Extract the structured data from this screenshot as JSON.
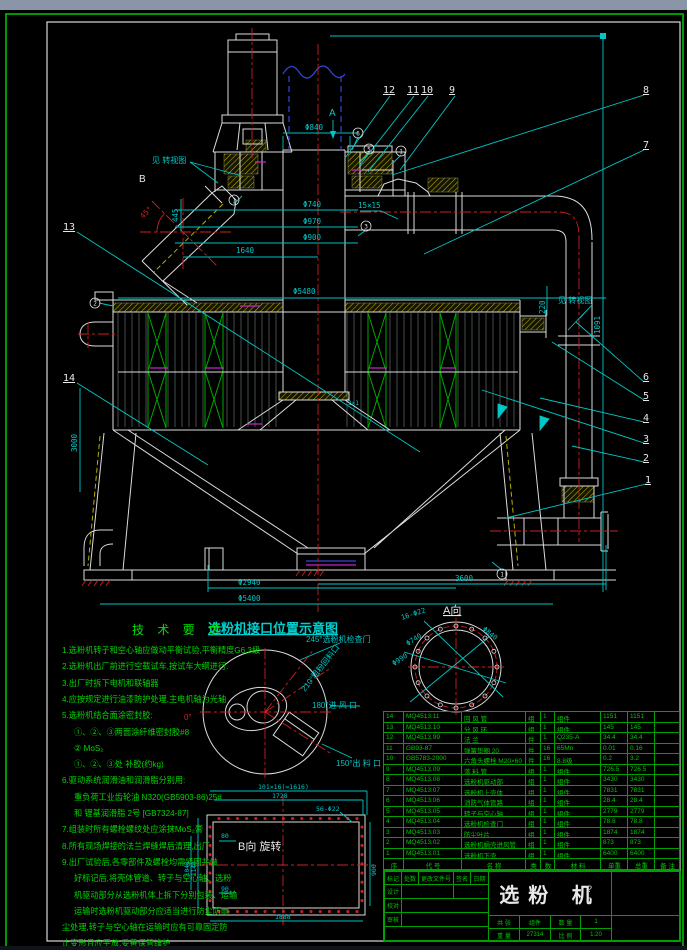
{
  "window": {
    "topbar_color": "#8b95a8",
    "paper_border_color": "#00c000"
  },
  "callouts": {
    "n1": "1",
    "n2": "2",
    "n3": "3",
    "n4": "4",
    "n5": "5",
    "n6": "6",
    "n7": "7",
    "n8": "8",
    "n9": "9",
    "n10": "10",
    "n11": "11",
    "n12": "12",
    "n13": "13",
    "n14": "14"
  },
  "circled": {
    "p6": "6",
    "p5": "5",
    "p1a": "1",
    "p1b": "1",
    "p3": "3",
    "p2": "2",
    "p1c": "1"
  },
  "views": {
    "arrow_a": "A",
    "arrow_b": "B",
    "rot_view_left": "见 转视图",
    "rot_view_right": "见 转视图",
    "a_view": "A向",
    "b_view": "B向 旋转",
    "schematic_title": "选粉机接口位置示意图"
  },
  "dims": {
    "phi840": "Φ840",
    "phi740": "Φ740",
    "phi970": "Φ970",
    "phi900": "Φ900",
    "d15": "15×15",
    "d1640": "1640",
    "phi5480": "Φ5480",
    "d445": "445",
    "d45": "45°",
    "d3000": "3000",
    "d220": "220",
    "d1091": "1091",
    "d3600": "3600",
    "phi2940": "Φ2940",
    "phi5400": "Φ5400",
    "d2x1": "2×1"
  },
  "schematic": {
    "deg0": "0°",
    "deg245": "245°选粉机检查门",
    "deg210": "210°粗粉回料口",
    "deg180": "180°进 风 口",
    "deg150": "150°出 料 口"
  },
  "a_view_dims": {
    "bolts": "16-Φ22",
    "phi740": "Φ740",
    "phi990": "Φ990",
    "phi840": "Φ840"
  },
  "b_view_dims": {
    "pitch": "101×16(=1616)",
    "w1728": "1728",
    "bolts": "56-Φ22",
    "d80": "80",
    "d90": "90",
    "h900": "900",
    "w1888": "1888",
    "h1140": "1140",
    "h1040": "1040"
  },
  "tech": {
    "title": "技 术 要 求",
    "lines": [
      {
        "t": "1.选粉机转子和空心轴应做动平衡试验,平衡精度G6.3级",
        "i": 0
      },
      {
        "t": "2.选粉机出厂前进行空载试车,按试车大纲进行.",
        "i": 0
      },
      {
        "t": "3.出厂时拆下电机和联轴器",
        "i": 0
      },
      {
        "t": "4.应按规定进行油漆防护处理,主电机轴为光轴",
        "i": 0
      },
      {
        "t": "5.选粉机结合面涂密封胶:",
        "i": 0
      },
      {
        "t": "①、②、③两面涂纤维密封胶#8",
        "i": 1
      },
      {
        "t": "② MoS₂",
        "i": 1
      },
      {
        "t": "①、②、③处 补胶(约kg)",
        "i": 1
      },
      {
        "t": "6.驱动系统润滑油和润滑脂分别用:",
        "i": 0
      },
      {
        "t": "重负荷工业齿轮油 N320(GB5903-86)25#",
        "i": 1
      },
      {
        "t": "和 锂基润滑脂 2号 [GB7324-87]",
        "i": 1
      },
      {
        "t": "7.组装时所有螺栓螺纹处应涂抹MoS₂膏",
        "i": 0
      },
      {
        "t": "8.所有现场焊接的法兰焊缝焊后清理,出厂",
        "i": 0
      },
      {
        "t": "9.出厂试验后,各零部件及螺栓均需紧固并做",
        "i": 0
      },
      {
        "t": "好标记后,将壳体管道、转子与空心轴、选粉",
        "i": 1
      },
      {
        "t": "机驱动部分从选粉机体上拆下分别包装、运输",
        "i": 1
      },
      {
        "t": "运输时选粉机驱动部分应适当进行防尘防雨",
        "i": 1
      },
      {
        "t": "尘处理,转子与空心轴在运输时应有可靠固定防",
        "i": 0
      },
      {
        "t": "止变形且应平放,妥善保管维护",
        "i": 0
      }
    ]
  },
  "parts_table": {
    "headers": [
      "序",
      "代 号",
      "名 称",
      "类",
      "数",
      "材 料",
      "单重",
      "总重",
      "备 注"
    ],
    "rows": [
      [
        "14",
        "MQ4513.11",
        "回 风 管",
        "组",
        "1",
        "组件",
        "1151",
        "1151",
        ""
      ],
      [
        "13",
        "MQ4513.10",
        "分 风 环",
        "组",
        "1",
        "组件",
        "145",
        "145",
        ""
      ],
      [
        "12",
        "MQ4513.99",
        "法  兰",
        "件",
        "1",
        "Q235-A",
        "34.4",
        "34.4",
        ""
      ],
      [
        "11",
        "GB93-87",
        "弹簧垫圈 20",
        "件",
        "16",
        "65Mn",
        "0.01",
        "0.16",
        ""
      ],
      [
        "10",
        "GB5783-2000",
        "六角头螺栓 M20×60",
        "件",
        "16",
        "8.8级",
        "0.2",
        "3.2",
        ""
      ],
      [
        "9",
        "MQ4513.09",
        "落 料 管",
        "组",
        "1",
        "组件",
        "726.5",
        "726.5",
        ""
      ],
      [
        "8",
        "MQ4513.08",
        "选粉机驱动部",
        "组",
        "1",
        "组件",
        "3430",
        "3430",
        ""
      ],
      [
        "7",
        "MQ4513.07",
        "选粉机上壳体",
        "组",
        "1",
        "组件",
        "7831",
        "7831",
        ""
      ],
      [
        "6",
        "MQ4513.06",
        "消防气体管路",
        "组",
        "1",
        "组件",
        "28.4",
        "28.4",
        ""
      ],
      [
        "5",
        "MQ4513.05",
        "转子与空心轴",
        "组",
        "1",
        "组件",
        "2779",
        "2779",
        ""
      ],
      [
        "4",
        "MQ4513.04",
        "选粉机检查门",
        "组",
        "1",
        "组件",
        "78.8",
        "78.8",
        ""
      ],
      [
        "3",
        "MQ4513.03",
        "防尘叶片",
        "组",
        "1",
        "组件",
        "1874",
        "1874",
        ""
      ],
      [
        "2",
        "MQ4513.02",
        "选粉机蜗壳进风管",
        "组",
        "1",
        "组件",
        "873",
        "873",
        ""
      ],
      [
        "1",
        "MQ4513.01",
        "选粉机下壳",
        "组",
        "1",
        "组件",
        "6400",
        "6400",
        ""
      ]
    ]
  },
  "title_block": {
    "title": "选粉 机",
    "rev_row": [
      "标记",
      "处数",
      "更改文件号",
      "签名",
      "日期"
    ],
    "sign_rows": [
      "设计",
      "校对",
      "审核"
    ],
    "fields": {
      "sheet_label": "共 张",
      "stage": "组件",
      "qty_label": "数 量",
      "qty": "1",
      "weight_label": "重 量",
      "weight": "27314",
      "scale_label": "比 例",
      "scale": "1:20",
      "q1": "?",
      "q2": "?"
    }
  }
}
